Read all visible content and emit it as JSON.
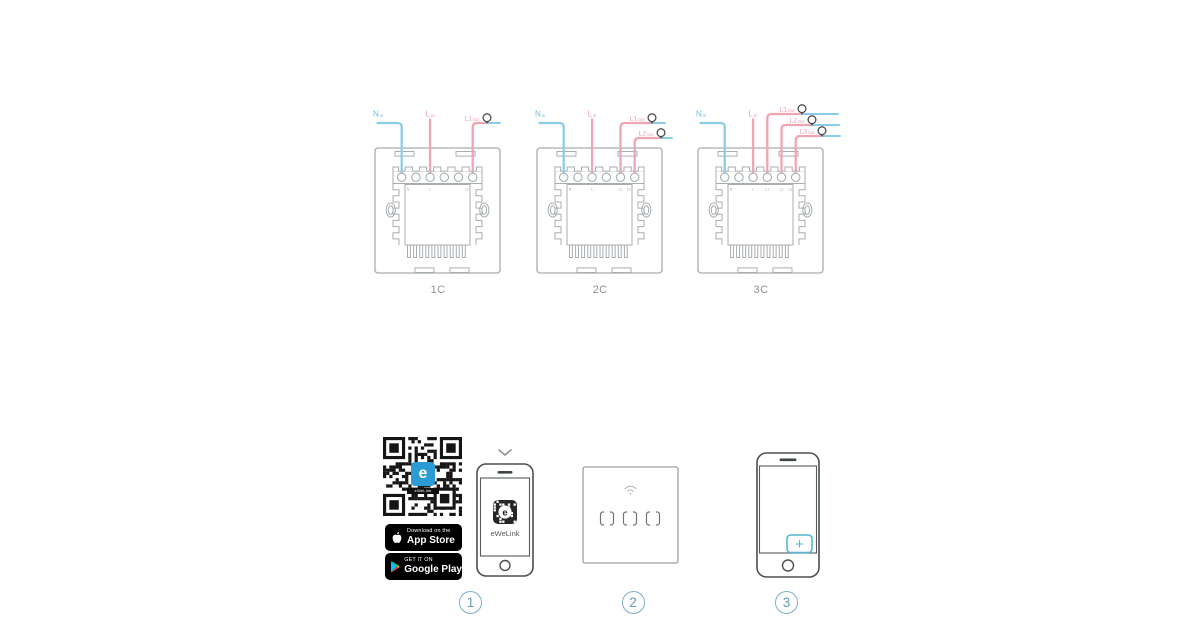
{
  "wiring": {
    "colors": {
      "wire_blue": "#8bcde9",
      "wire_pink": "#efa6b2",
      "label_blue": "#6fbde2",
      "label_pink": "#ec9fac",
      "outline": "#a8adb0",
      "bulb": "#4d4d4d",
      "caption": "#8d9295",
      "marks": "#9ba0a3"
    },
    "switches": [
      {
        "caption": "1C",
        "wires": [
          {
            "kind": "n",
            "label": "N",
            "sub": "in",
            "terminal": 0
          },
          {
            "kind": "l",
            "label": "L",
            "sub": "in",
            "terminal": 2
          },
          {
            "kind": "out",
            "label": "L1",
            "sub": "Out",
            "terminal": 5
          }
        ]
      },
      {
        "caption": "2C",
        "wires": [
          {
            "kind": "n",
            "label": "N",
            "sub": "in",
            "terminal": 0
          },
          {
            "kind": "l",
            "label": "L",
            "sub": "in",
            "terminal": 2
          },
          {
            "kind": "out",
            "label": "L1",
            "sub": "Out",
            "terminal": 4
          },
          {
            "kind": "out",
            "label": "L2",
            "sub": "Out",
            "terminal": 5
          }
        ]
      },
      {
        "caption": "3C",
        "wires": [
          {
            "kind": "n",
            "label": "N",
            "sub": "in",
            "terminal": 0
          },
          {
            "kind": "l",
            "label": "L",
            "sub": "in",
            "terminal": 2
          },
          {
            "kind": "out",
            "label": "L1",
            "sub": "Out",
            "terminal": 3
          },
          {
            "kind": "out",
            "label": "L2",
            "sub": "Out",
            "terminal": 4
          },
          {
            "kind": "out",
            "label": "L3",
            "sub": "Out",
            "terminal": 5
          }
        ]
      }
    ]
  },
  "steps": {
    "accent": "#55b7d2",
    "qr": {
      "logo_letter": "e",
      "logo_caption": "eWeLink"
    },
    "appstore": {
      "line1": "Download on the",
      "line2": "App Store"
    },
    "googleplay": {
      "line1": "GET IT ON",
      "line2": "Google Play"
    },
    "phone1": {
      "app_letter": "e",
      "app_label": "eWeLink"
    },
    "phone2": {
      "plus": "+"
    },
    "numbers": [
      "1",
      "2",
      "3"
    ]
  }
}
